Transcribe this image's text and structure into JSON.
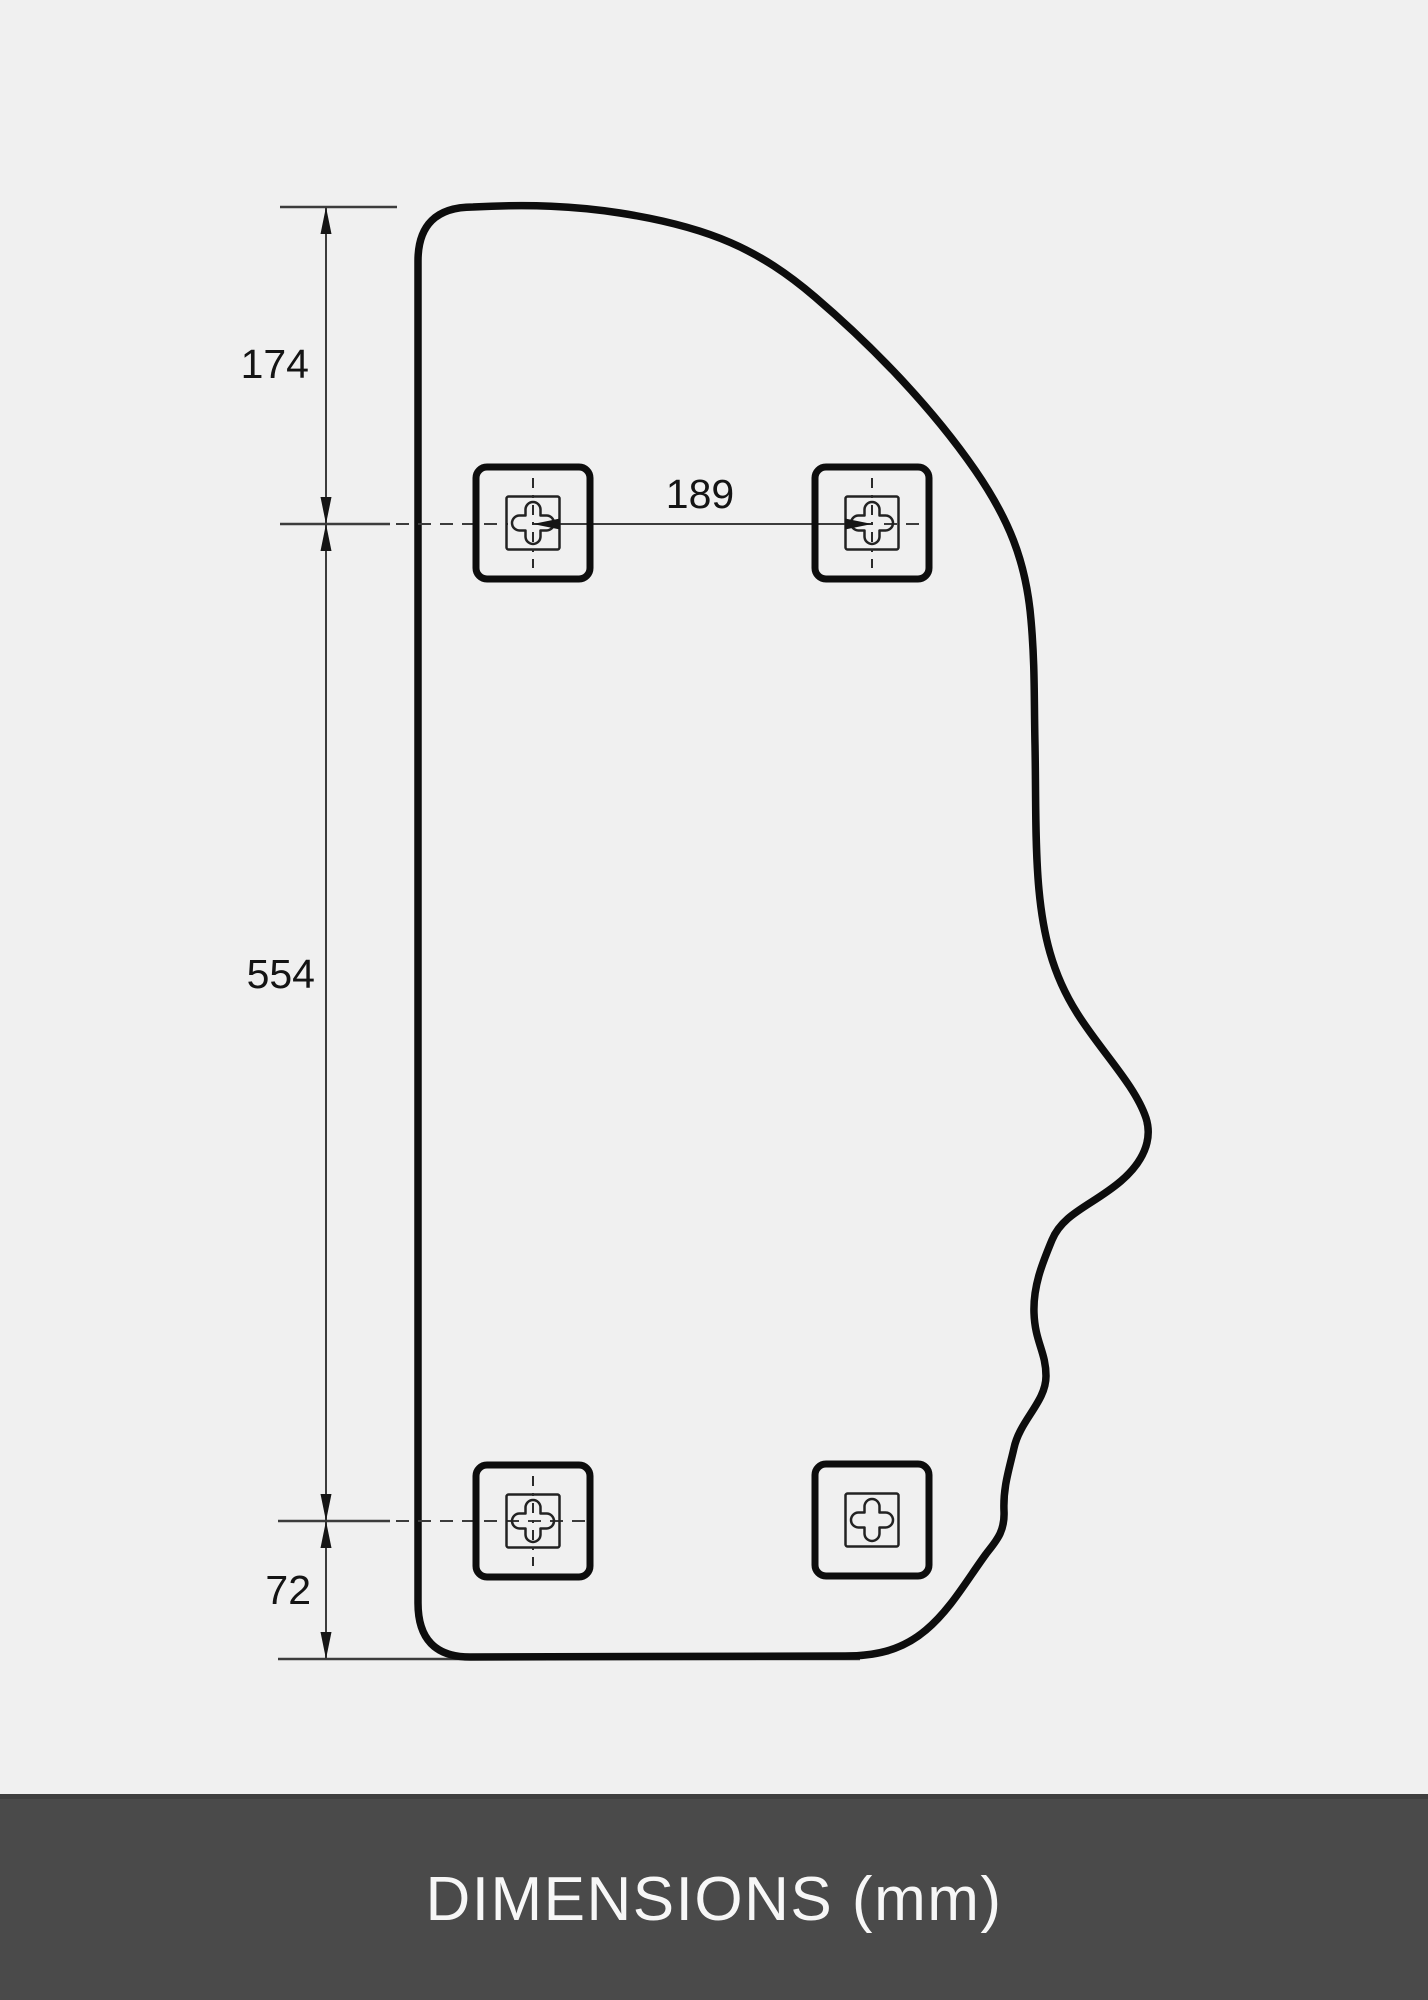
{
  "drawing": {
    "title": "face-profile mirror technical drawing",
    "unit_label": "DIMENSIONS (mm)",
    "dimensions": {
      "top_offset": "174",
      "hole_spacing_horizontal": "189",
      "hole_spacing_vertical": "554",
      "bottom_offset": "72"
    },
    "fixing_brackets_count": 4,
    "colors": {
      "background": "#f0f0f0",
      "outline": "#0d0d0d",
      "dimension_line": "#3c3c3c",
      "label_text": "#141414",
      "footer_background": "#4a4a4a",
      "footer_text": "#f7f7f7"
    }
  }
}
